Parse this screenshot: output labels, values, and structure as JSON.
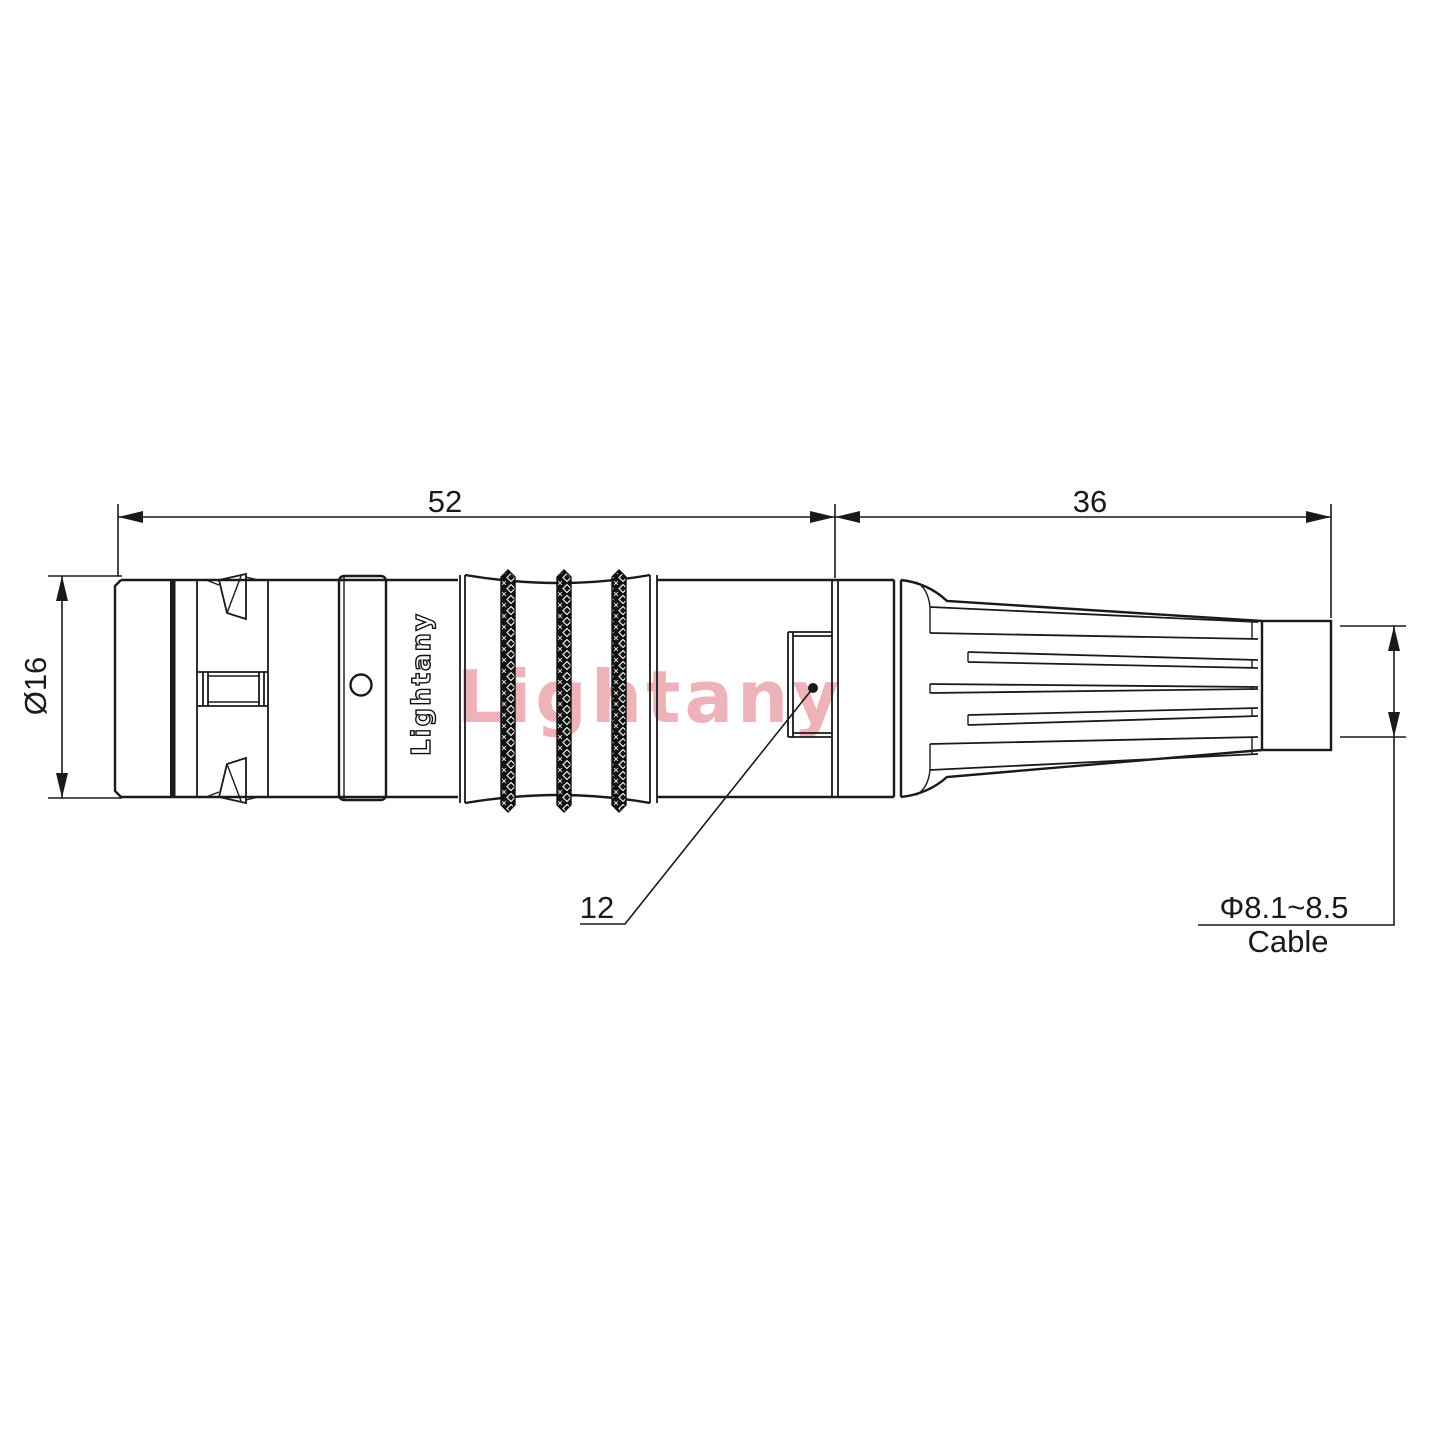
{
  "title": "Connector outline technical drawing",
  "colors": {
    "background": "#ffffff",
    "line": "#1a1a1a",
    "knurl": "#111111",
    "watermark": "#eeb3b8"
  },
  "watermark": {
    "text": "Lightany"
  },
  "body": {
    "marking": "Lightany"
  },
  "dims": {
    "overall_length": "52",
    "boot_length": "36",
    "front_diameter": "Ø16",
    "rear_section_length": "12",
    "cable_diameter": "Φ8.1~8.5",
    "cable_word": "Cable"
  }
}
